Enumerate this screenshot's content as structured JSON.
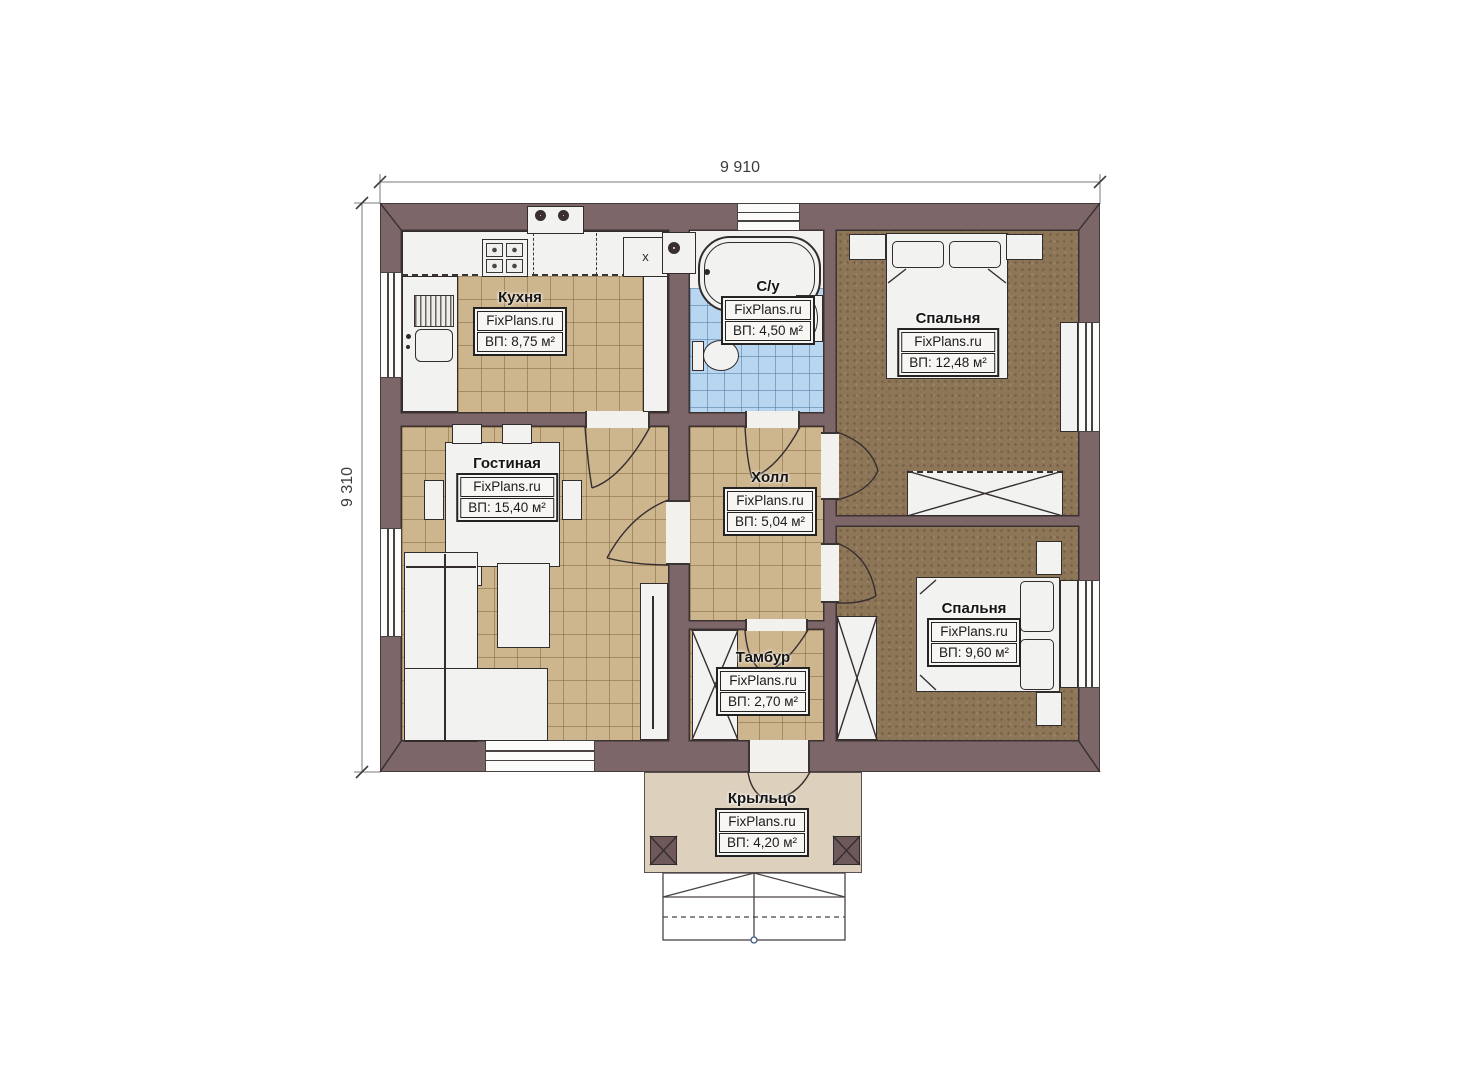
{
  "dims": {
    "width": "9 910",
    "height": "9 310"
  },
  "rooms": {
    "kitchen": {
      "name": "Кухня",
      "brand": "FixPlans.ru",
      "area": "ВП: 8,75 м²"
    },
    "bathroom": {
      "name": "С/у",
      "brand": "FixPlans.ru",
      "area": "ВП: 4,50 м²"
    },
    "bedroom_top": {
      "name": "Спальня",
      "brand": "FixPlans.ru",
      "area": "ВП: 12,48 м²"
    },
    "living": {
      "name": "Гостиная",
      "brand": "FixPlans.ru",
      "area": "ВП: 15,40 м²"
    },
    "hall": {
      "name": "Холл",
      "brand": "FixPlans.ru",
      "area": "ВП: 5,04 м²"
    },
    "vestibule": {
      "name": "Тамбур",
      "brand": "FixPlans.ru",
      "area": "ВП: 2,70 м²"
    },
    "bedroom_bottom": {
      "name": "Спальня",
      "brand": "FixPlans.ru",
      "area": "ВП: 9,60 м²"
    },
    "porch": {
      "name": "Крыльцо",
      "brand": "FixPlans.ru",
      "area": "ВП: 4,20 м²"
    }
  },
  "marks": {
    "kitchen_cabinet": "x"
  },
  "colors": {
    "wall": "#7c6668",
    "tile": "#cdb58d",
    "bath_tile": "#b8d6ef",
    "carpet": "#8d7557",
    "porch": "#ddd0bc"
  }
}
